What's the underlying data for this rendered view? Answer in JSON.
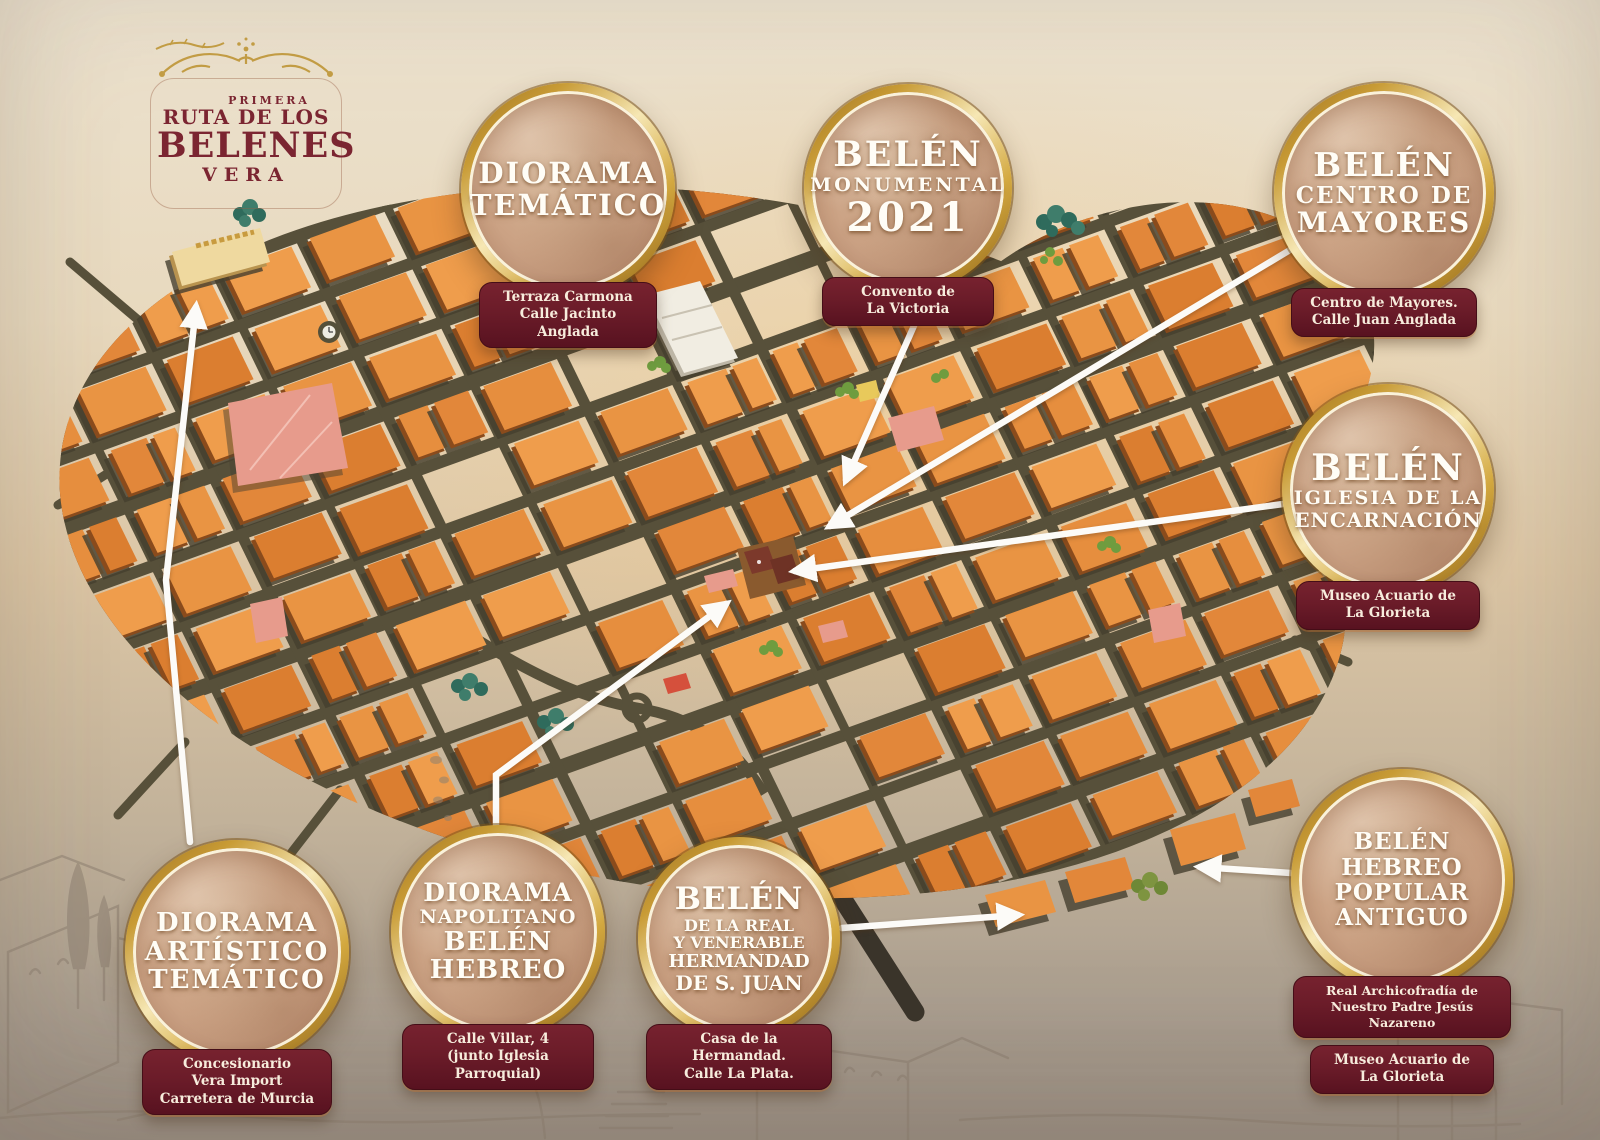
{
  "logo": {
    "lines": [
      "PRIMERA",
      "RUTA DE LOS",
      "BELENES",
      "VERA"
    ],
    "ornament_icon": "gold-flourish"
  },
  "badges": [
    {
      "id": "diorama-tematico",
      "title_lines": [
        "DIORAMA",
        "TEMÁTICO"
      ],
      "plaques": [
        [
          "Terraza Carmona",
          "Calle Jacinto Anglada"
        ]
      ]
    },
    {
      "id": "belen-monumental-2021",
      "title_lines": [
        "BELÉN",
        "MONUMENTAL",
        "2021"
      ],
      "plaques": [
        [
          "Convento de",
          "La Victoria"
        ]
      ]
    },
    {
      "id": "belen-centro-de-mayores",
      "title_lines": [
        "BELÉN",
        "CENTRO DE",
        "MAYORES"
      ],
      "plaques": [
        [
          "Centro de Mayores.",
          "Calle Juan Anglada"
        ]
      ]
    },
    {
      "id": "belen-iglesia-encarnacion",
      "title_lines": [
        "BELÉN",
        "IGLESIA DE LA",
        "ENCARNACIÓN"
      ],
      "plaques": [
        [
          "Museo Acuario de",
          "La Glorieta"
        ]
      ]
    },
    {
      "id": "diorama-artistico-tematico",
      "title_lines": [
        "DIORAMA",
        "ARTÍSTICO",
        "TEMÁTICO"
      ],
      "plaques": [
        [
          "Concesionario",
          "Vera Import",
          "Carretera de Murcia"
        ]
      ]
    },
    {
      "id": "diorama-napolitano-belen-hebreo",
      "title_lines": [
        "DIORAMA",
        "NAPOLITANO",
        "BELÉN",
        "HEBREO"
      ],
      "plaques": [
        [
          "Calle Villar, 4",
          "(junto Iglesia Parroquial)"
        ]
      ]
    },
    {
      "id": "belen-hermandad-san-juan",
      "title_lines": [
        "BELÉN",
        "DE LA REAL",
        "Y VENERABLE",
        "HERMANDAD",
        "DE S. JUAN"
      ],
      "plaques": [
        [
          "Casa de la Hermandad.",
          "Calle La Plata."
        ]
      ]
    },
    {
      "id": "belen-hebreo-popular-antiguo",
      "title_lines": [
        "BELÉN",
        "HEBREO",
        "POPULAR",
        "ANTIGUO"
      ],
      "plaques": [
        [
          "Real Archicofradía de",
          "Nuestro Padre Jesús Nazareno"
        ],
        [
          "Museo Acuario de",
          "La Glorieta"
        ]
      ]
    }
  ],
  "palette": {
    "gold_ring": "#C89B35",
    "plaque_maroon": "#6B1C29",
    "parchment": "#C9A183",
    "building_orange": "#E8923F",
    "road_olive": "#57503A",
    "arrow_white": "#FFFFFF",
    "logo_maroon": "#7B2531",
    "background_beige": "#E6D6BB"
  }
}
